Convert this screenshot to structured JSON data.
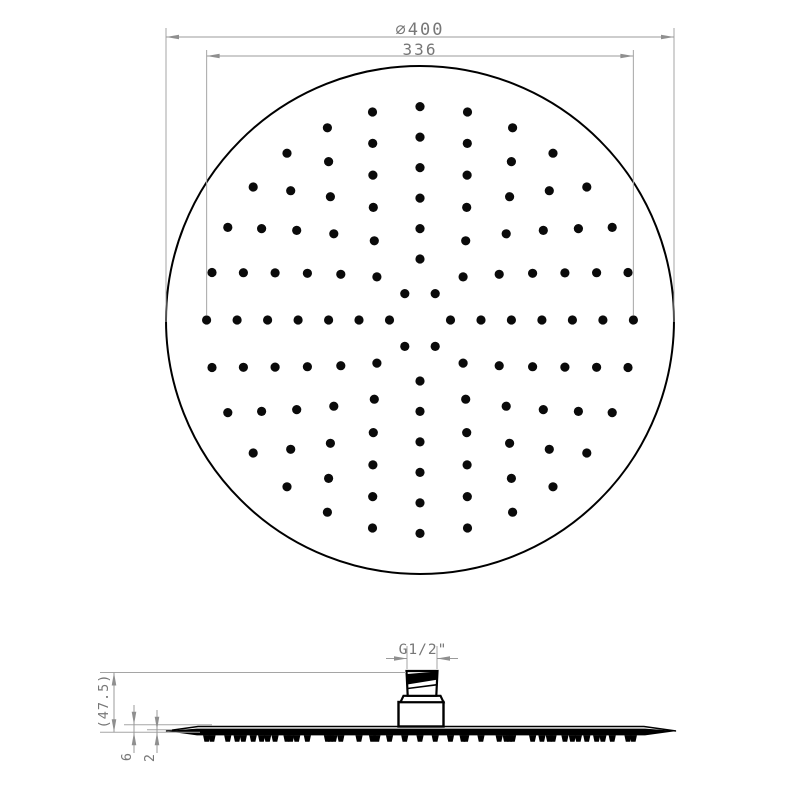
{
  "drawing": {
    "type": "technical-drawing",
    "subject": "round rain shower head, top view and side view",
    "colors": {
      "background": "#ffffff",
      "object_line": "#000000",
      "nozzle_dot": "#0a0a0a",
      "dimension_line": "#9b9b9b",
      "extension_line": "#a5a5a5",
      "arrow": "#8f8f8f",
      "dim_text": "#777777"
    }
  },
  "top_view": {
    "diameter_label": "∅400",
    "span_label": "336",
    "diameter_mm": 400,
    "nozzle_circle_diameter_mm": 336,
    "nozzle_rings": [
      {
        "radius_mm": 24,
        "count": 6
      },
      {
        "radius_mm": 48,
        "count": 8
      },
      {
        "radius_mm": 72,
        "count": 12
      },
      {
        "radius_mm": 96,
        "count": 16
      },
      {
        "radius_mm": 120,
        "count": 20
      },
      {
        "radius_mm": 144,
        "count": 24
      },
      {
        "radius_mm": 168,
        "count": 28
      }
    ]
  },
  "side_view": {
    "thread_label": "G1/2\"",
    "height_label": "(47.5)",
    "plate_thickness_label": "6",
    "edge_thickness_label": "2",
    "height_mm": 47.5,
    "plate_thickness_mm": 6,
    "edge_thickness_mm": 2
  }
}
